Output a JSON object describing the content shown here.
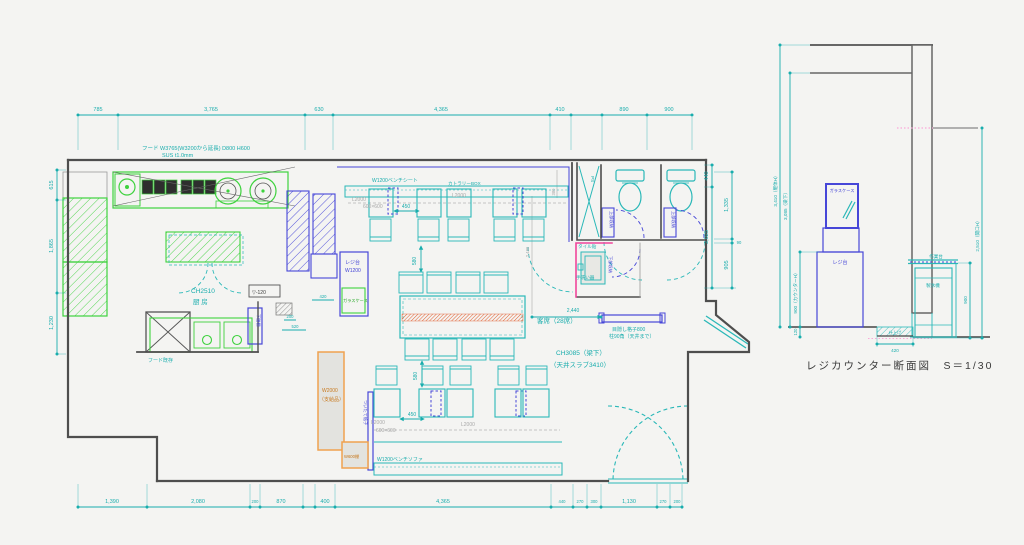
{
  "plan": {
    "labels": {
      "hood_line1": "フード W3765(W3200から延長) D800 H600",
      "hood_line2": "SUS t1.0mm",
      "kitchen_ch": "CH2510",
      "kitchen_name": "厨 房",
      "step_down": "▽-120",
      "hood_existing": "フード既存",
      "lower_shelf": "下膳棚",
      "register_stand": "レジ台",
      "register_width": "W1200",
      "glass_case": "ガラスケース",
      "bench_top": "W1200ベンチシート",
      "cutlery_box": "カトラリーBOX",
      "bench_bottom": "W1200ベンチソファ",
      "partition": "ついたて格子",
      "supplied_w": "W2000",
      "supplied_note": "（支給品）",
      "shelf_600": "W600棚",
      "seats": "客席（28席）",
      "ceiling_height": "CH3085（梁下）",
      "ceiling_slab": "（天井スラブ3410）",
      "louver_1": "目隠し格子800",
      "louver_2": "柱90角（天井まで）",
      "ps": "PS",
      "upper_storage": "上部収納",
      "lower_storage": "下部収納",
      "tile": "タイル貼",
      "handwash": "手洗い器",
      "ghost_l2000": "L2000",
      "ghost_600": "600×600"
    },
    "dims": {
      "top": [
        "785",
        "3,765",
        "630",
        "4,365",
        "410",
        "890",
        "900"
      ],
      "left": [
        "615",
        "1,865",
        "1,230"
      ],
      "right_inner": [
        "440",
        "2,025"
      ],
      "right_outer": [
        "1,335",
        "90",
        "905"
      ],
      "bottom": [
        "1,390",
        "2,080",
        "200",
        "870",
        "400",
        "4,365",
        "440",
        "270",
        "300",
        "1,130",
        "270",
        "200"
      ],
      "inner": {
        "d450": "450",
        "d580": "580",
        "d2440": "2,440",
        "d200": "200",
        "d520": "520",
        "d420": "420",
        "d380": "380",
        "d2480": "2,480"
      }
    }
  },
  "section": {
    "title": "レジカウンター断面図　S＝1/30",
    "labels": {
      "glass_case": "ガラスケース",
      "register_stand": "レジ台",
      "work_table": "作業台",
      "ice_maker": "製氷機",
      "floor_finish": "仕上げ"
    },
    "dims": {
      "body_h": "3,410（躯体H）",
      "beam_h": "3,085（梁下）",
      "counter_h": "900（カウンターH）",
      "step": "120",
      "opening_h": "2,510（開口H）",
      "work_h": "900",
      "recess_w": "420"
    }
  }
}
